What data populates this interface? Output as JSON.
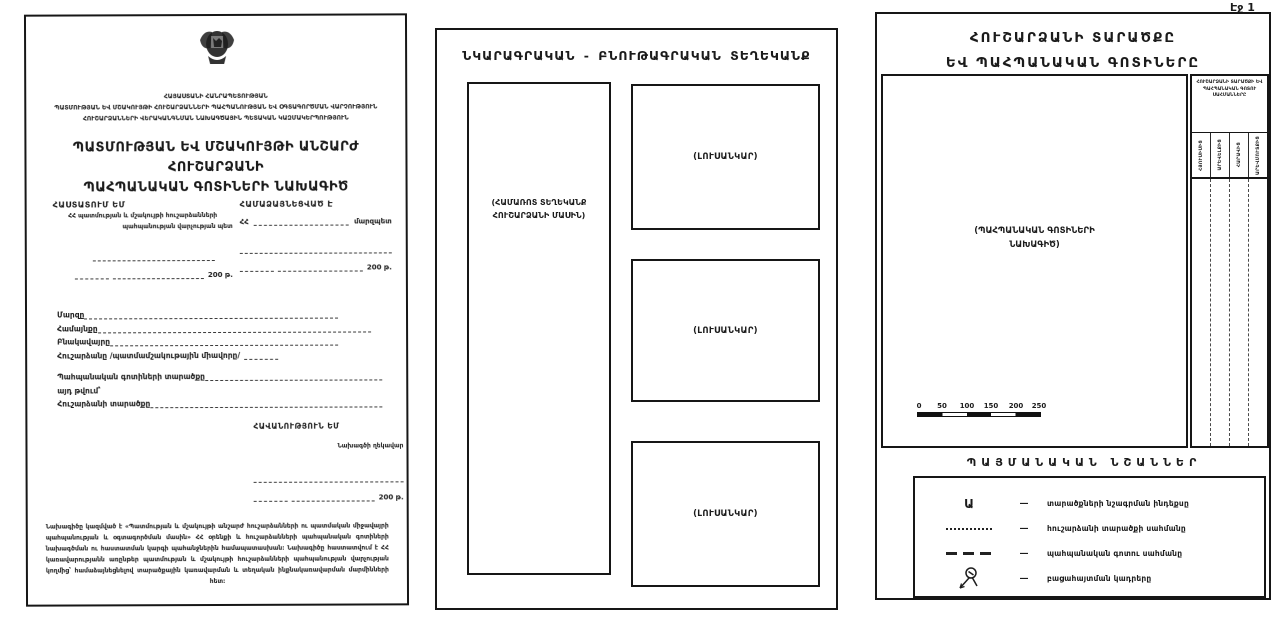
{
  "doc": {
    "page_label": "Էջ 1"
  },
  "icons": {
    "coat_of_arms": "armenia-coat-of-arms",
    "photo_station": "survey-photo-point-tripod"
  },
  "panel1": {
    "org_lines": [
      "ՀԱՅԱՍՏԱՆԻ ՀԱՆՐԱՊԵՏՈՒԹՅԱՆ",
      "ՊԱՏՄՈՒԹՅԱՆ ԵՎ ՄՇԱԿՈՒՅԹԻ ՀՈՒՇԱՐՁԱՆՆԵՐԻ ՊԱՀՊԱՆՈՒԹՅԱՆ ԵՎ ՕԳՏԱԳՈՐԾՄԱՆ ՎԱՐՉՈՒԹՅՈՒՆ",
      "ՀՈՒՇԱՐՁԱՆՆԵՐԻ ՎԵՐԱԿԱՆԳՆՄԱՆ ՆԱԽԱԳԾԱՅԻՆ ՊԵՏԱԿԱՆ ԿԱԶՄԱԿԵՐՊՈՒԹՅՈՒՆ"
    ],
    "title_line1": "ՊԱՏՄՈՒԹՅԱՆ ԵՎ ՄՇԱԿՈՒՅԹԻ ԱՆՇԱՐԺ ՀՈՒՇԱՐՁԱՆԻ",
    "title_line2": "ՊԱՀՊԱՆԱԿԱՆ ԳՈՏԻՆԵՐԻ ՆԱԽԱԳԻԾ",
    "approve_block": {
      "heading": "ՀԱՍՏԱՏՈՒՄ ԵՄ",
      "line1": "ՀՀ պատմության և մշակույթի հուշարձանների",
      "line2": "պահպանության վարչության պետ",
      "date_suffix": "200 թ."
    },
    "agree_block": {
      "heading": "ՀԱՄԱՁԱՅՆԵՑՎԱԾ Է",
      "prefix": "ՀՀ",
      "role": "մարզպետ",
      "date_suffix": "200 թ."
    },
    "fields": [
      {
        "label": "Մարզը"
      },
      {
        "label": "Համայնքը"
      },
      {
        "label": "Բնակավայրը"
      },
      {
        "label": "Հուշարձանը /պատմամշակութային միավորը/"
      },
      {
        "label": "Պահպանական գոտիների տարածքը"
      },
      {
        "label": "այդ թվում՝"
      },
      {
        "label": "Հուշարձանի տարածքը"
      }
    ],
    "approve2_block": {
      "heading": "ՀԱՎԱՆՈՒԹՅՈՒՆ ԵՄ",
      "role": "Նախագծի ղեկավար",
      "date_suffix": "200 թ."
    },
    "footer_text": "Նախագիծը կազմված է «Պատմության և մշակույթի անշարժ հուշարձանների ու պատմական միջավայրի պահպանության և օգտագործման մասին» ՀՀ օրենքի և հուշարձանների պահպանական գոտիների նախագծման ու հաստատման կարգի պահանջներին համապատասխան։ Նախագիծը հաստատվում է ՀՀ կառավարությանն առընթեր պատմության և մշակույթի հուշարձանների պահպանության վարչության կողմից՝ համաձայնեցնելով տարածքային կառավարման և տեղական ինքնակառավարման մարմինների հետ։"
  },
  "panel2": {
    "title": "ՆԿԱՐԱԳՐԱԿԱՆ - ԲՆՈՒԹԱԳՐԱԿԱՆ ՏԵՂԵԿԱՆՔ",
    "left_box_label_line1": "(ՀԱՄԱՌՈՏ ՏԵՂԵԿԱՆՔ",
    "left_box_label_line2": "ՀՈՒՇԱՐՁԱՆԻ ՄԱՍԻՆ)",
    "photo_labels": [
      "(ԼՈՒՍԱՆԿԱՐ)",
      "(ԼՈՒՍԱՆԿԱՐ)",
      "(ԼՈՒՍԱՆԿԱՐ)"
    ]
  },
  "panel3": {
    "title_line1": "ՀՈՒՇԱՐՁԱՆԻ ՏԱՐԱԾՔԸ",
    "title_line2": "ԵՎ ՊԱՀՊԱՆԱԿԱՆ ԳՈՏԻՆԵՐԸ",
    "map_label_line1": "(ՊԱՀՊԱՆԱԿԱՆ ԳՈՏԻՆԵՐԻ",
    "map_label_line2": "ՆԱԽԱԳԻԾ)",
    "scale_ticks": [
      "0",
      "50",
      "100",
      "150",
      "200",
      "250"
    ],
    "side_table": {
      "header": "ՀՈՒՇԱՐՁԱՆԻ ՏԱՐԱԾՔԻ ԵՎ ՊԱՀՊԱՆԱԿԱՆ ԳՈՏՈՒ ՍԱՀՄԱՆՆԵՐԸ",
      "columns": [
        "ՀՅՈՒՍԻՍԻՑ",
        "ԱՐԵՎԵԼՔԻՑ",
        "ՀԱՐԱՎԻՑ",
        "ԱՐԵՎՄՈՒՏՔԻՑ"
      ]
    },
    "legend": {
      "title": "ՊԱՅՄԱՆԱԿԱՆ ՆՇԱՆՆԵՐ",
      "separator": "—",
      "items": [
        {
          "symbol": "letter-a-index",
          "symbol_text": "Ա",
          "label": "տարածքների նշագրման ինդեքսը"
        },
        {
          "symbol": "dotted-line",
          "label": "հուշարձանի տարածքի սահմանը"
        },
        {
          "symbol": "dashed-line",
          "label": "պահպանական գոտու սահմանը"
        },
        {
          "symbol": "photo-station",
          "label": "բացահայտման կադրերը"
        }
      ]
    }
  }
}
